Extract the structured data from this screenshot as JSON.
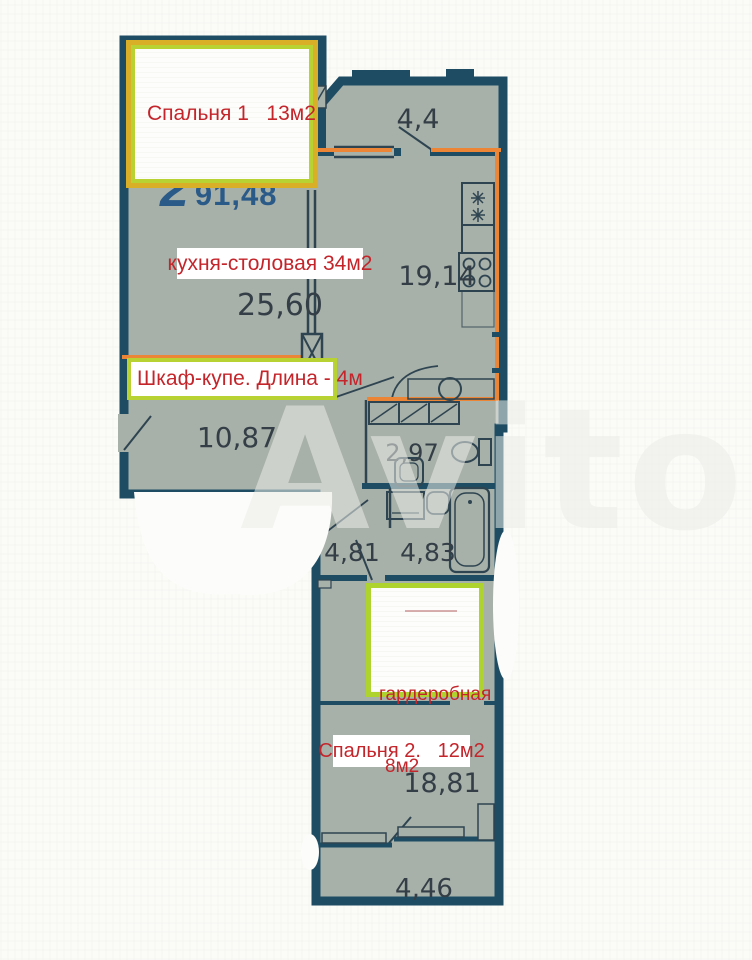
{
  "watermark": "Avito",
  "colors": {
    "wall": "#1e4d63",
    "partition": "#2e4450",
    "room_fill": "#a7b0a9",
    "highlight_orange": "#ec8636",
    "box_border_gold": "#d9af28",
    "box_border_lime": "#b9d233",
    "label_red": "#c4252b",
    "logo_blue": "#2a5a88",
    "number_gray": "#343e46"
  },
  "annotations": {
    "bedroom1": "Спальня 1   13м2",
    "kitchen_dining": "кухня-столовая 34м2",
    "wardrobe": "Шкаф-купе. Длина - 4м",
    "closet_line1": "гардеробная",
    "closet_line2": "8м2",
    "bedroom2": "Спальня 2.   12м2",
    "logo_digit": "2",
    "total_area": "91,48"
  },
  "room_areas": {
    "balcony_top": "4,4",
    "kitchen": "19,14",
    "dining": "25,60",
    "hallway": "10,87",
    "wc": "2,97",
    "corridor": "4,81",
    "bathroom": "4,83",
    "bedroom2": "18,81",
    "balcony_bottom": "4,46"
  }
}
